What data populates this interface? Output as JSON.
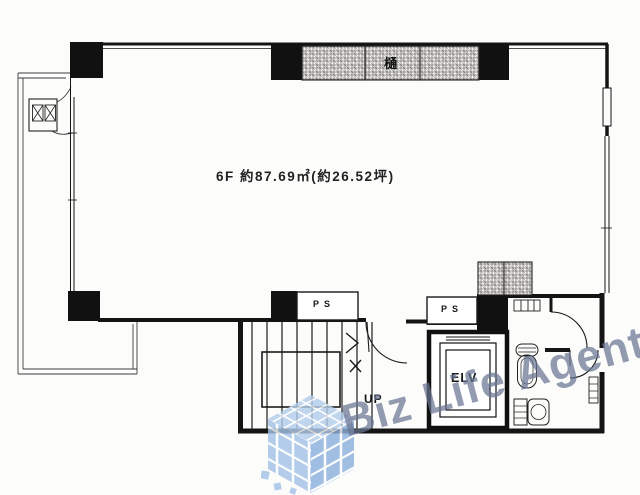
{
  "room": {
    "area_label": "6F 約87.69㎡(約26.52坪)"
  },
  "labels": {
    "ps_left": "PS",
    "ps_right": "PS",
    "elevator": "ELV",
    "stairs_up": "UP",
    "hatch_block": "樋"
  },
  "watermark": {
    "brand": "Biz Life Agent",
    "text_color": "#687591",
    "tile_color_top": "#b3cdec",
    "tile_color_left": "#a3c2e6",
    "tile_color_right": "#8db0dd"
  },
  "colors": {
    "line": "#161616",
    "background": "#fcfcfb"
  }
}
